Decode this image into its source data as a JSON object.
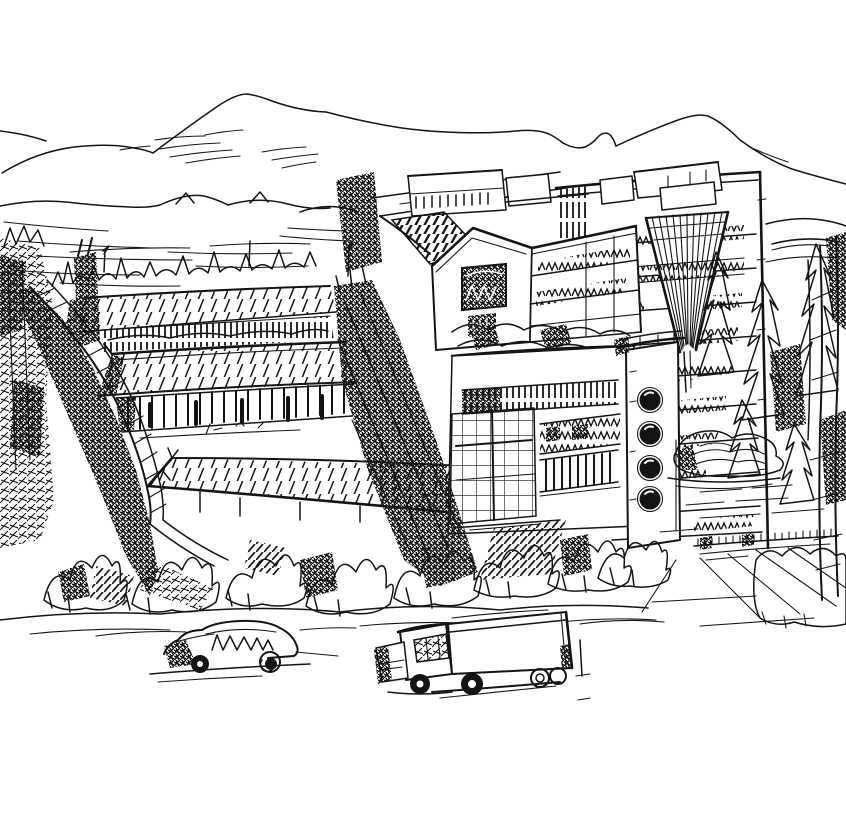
{
  "artwork": {
    "medium": "pen-and-ink architectural sketch",
    "palette": {
      "ink": "#141414",
      "paper": "#ffffff"
    },
    "aria_label": "Hand-drawn ink sketch of a hillside campus: traditional long halls with hatched tile roofs and a colonnade on the left, a modern mid-rise block with a gabled pavilion, rooftop garden and a white porthole tower in the center, a taller slab building with a V-shaped louver on the right, mountain ridges behind, dense trees and shrubs, an open plaza with rocks and a low picket fence, and a sedan car and a box truck in the foreground",
    "elements": {
      "mountains": "mountain ridgelines with light contour shading",
      "hills": "rolling foothills and terraced field strokes",
      "treeline": "spiky treeline behind the halls",
      "corridor_wall": "long covered corridor wall descending diagonally",
      "hall_upper": "upper long hall with hatched pitched roof and ridge ornament row",
      "hall_middle": "middle long hall with hatched roof and post colonnade",
      "hall_foreground": "foreground long hall with hatched roof",
      "center_building": "mid-rise block with rooftop boxes, roof garden, window bands and grid curtain wall",
      "gable_house": "gabled pavilion with dark arched window",
      "porthole_tower": "white stair tower with four round windows",
      "right_building": "tall slab building with V-shaped louver and zigzag window bands",
      "dark_tree": "dark scribbled tree mass between buildings",
      "trees_left": "scribbled trees along the left edge",
      "trees_right": "conifers and tall thin trees on the right",
      "shrubs": "foreground shrub and grass row",
      "rocks": "rock-garden boulders with swirl strokes",
      "plaza": "open plaza with paving strokes",
      "fence": "low fence with small pickets",
      "car": "sketched sedan car with zigzag windows",
      "truck": "sketched box truck"
    },
    "counts": {
      "portholes": 4,
      "vehicles": 2,
      "hall_roofs": 3
    }
  }
}
